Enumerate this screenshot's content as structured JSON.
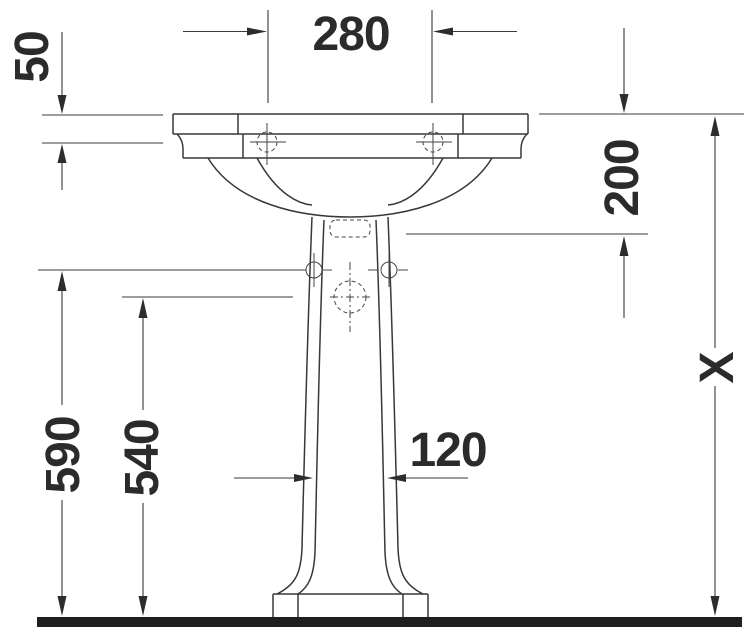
{
  "drawing": {
    "labels": {
      "top_spread": "280",
      "rim_height": "50",
      "drain_depth": "200",
      "total_height": "X",
      "fixing_height": "590",
      "trap_height": "540",
      "pedestal_width": "120"
    },
    "colors": {
      "line": "#383838",
      "label": "#2b2b2b",
      "floor": "#1e1e1e",
      "background": "#ffffff"
    }
  }
}
